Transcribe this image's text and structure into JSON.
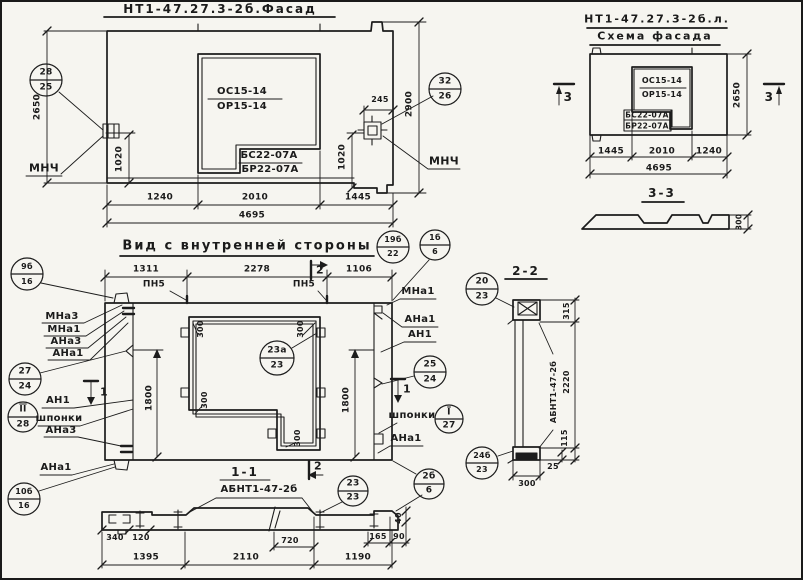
{
  "facade": {
    "title": "НТ1-47.27.3-2б.Фасад",
    "win": {
      "os": "ОС15-14",
      "or": "ОР15-14",
      "bs": "БС22-07А",
      "br": "БР22-07А"
    },
    "dims": {
      "h_left": "2650",
      "h_right": "2900",
      "a_left": "1020",
      "a_right": "1020",
      "offset": "245",
      "b1": "1240",
      "b2": "2010",
      "b3": "1445",
      "total": "4695"
    },
    "c_left": {
      "top": "28",
      "bot": "25"
    },
    "c_right": {
      "top": "32",
      "bot": "26"
    },
    "mnch_left": "МНЧ",
    "mnch_right": "МНЧ"
  },
  "scheme": {
    "title1": "НТ1-47.27.3-2б.л.",
    "title2": "Схема фасада",
    "win": {
      "os": "ОС15-14",
      "or": "ОР15-14",
      "bs": "БС22-07А",
      "br": "БР22-07А"
    },
    "dims": {
      "h_right": "2650",
      "b1": "1445",
      "b2": "2010",
      "b3": "1240",
      "total": "4695"
    },
    "m_left": "3",
    "m_right": "3",
    "s33": {
      "title": "3-3",
      "d300": "300"
    }
  },
  "inner": {
    "title": "Вид с внутренней стороны",
    "pn5_a": "ПН5",
    "pn5_b": "ПН5",
    "m2_top": "2",
    "m2_bot": "2",
    "m1_left": "1",
    "m1_right": "1",
    "dims": {
      "t1": "1311",
      "t2": "2278",
      "t3": "1106",
      "v_left": "1800",
      "v_right": "1800",
      "w_tl": "300",
      "w_tr": "300",
      "w_ml": "300",
      "w_br": "300"
    },
    "left": {
      "l1": "МНа3",
      "l2": "МНа1",
      "l3": "АНа3",
      "l4": "АНа1",
      "l5": "АН1",
      "l6": "шпонки",
      "l7": "АНа3",
      "l8": "АНа1"
    },
    "right": {
      "r1": "МНа1",
      "r2": "АНа1",
      "r3": "АН1",
      "r4": "шпонки",
      "r5": "АНа1"
    },
    "c9b": {
      "top": "9б",
      "bot": "16"
    },
    "c19b": {
      "top": "19б",
      "bot": "22"
    },
    "c1b": {
      "top": "1б",
      "bot": "6"
    },
    "c27": {
      "top": "27",
      "bot": "24"
    },
    "c2_28": {
      "top": "II",
      "bot": "28"
    },
    "c10b": {
      "top": "10б",
      "bot": "16"
    },
    "c23a": {
      "top": "23а",
      "bot": "23"
    },
    "c25": {
      "top": "25",
      "bot": "24"
    },
    "c1_27": {
      "top": "I",
      "bot": "27"
    },
    "c2b6": {
      "top": "2б",
      "bot": "6"
    }
  },
  "sec11": {
    "title": "1-1",
    "subtitle": "АБНТ1-47-2б",
    "m2": "2",
    "c23": {
      "top": "23",
      "bot": "23"
    },
    "dims": {
      "d340": "340",
      "d120": "120",
      "d720": "720",
      "d165": "165",
      "d90": "90",
      "d40": "40",
      "b1": "1395",
      "b2": "2110",
      "b3": "1190"
    }
  },
  "sec22": {
    "title": "2-2",
    "label": "АБНТ1-47-2б",
    "c_top": {
      "top": "20",
      "bot": "23"
    },
    "c_bot": {
      "top": "24б",
      "bot": "23"
    },
    "dims": {
      "d315": "315",
      "d2220": "2220",
      "d115": "115",
      "d25": "25",
      "d300": "300"
    }
  }
}
